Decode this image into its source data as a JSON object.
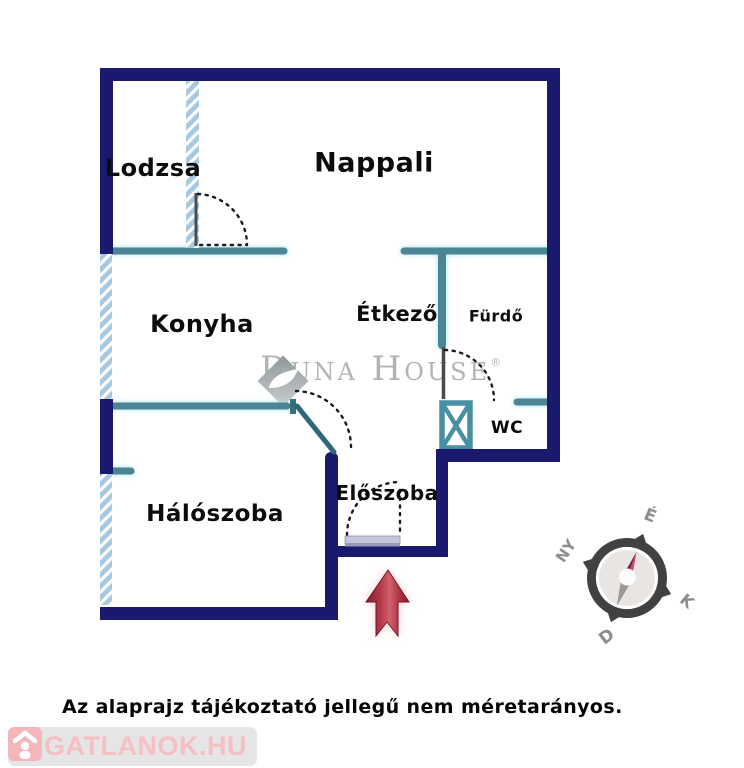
{
  "floor_plan": {
    "rooms": [
      {
        "name": "Lodzsa"
      },
      {
        "name": "Nappali"
      },
      {
        "name": "Konyha"
      },
      {
        "name": "Étkező"
      },
      {
        "name": "Fürdő"
      },
      {
        "name": "WC"
      },
      {
        "name": "Hálószoba"
      },
      {
        "name": "Előszoba"
      }
    ],
    "compass": {
      "north": "É",
      "west": "NY",
      "east": "K",
      "south": "D"
    },
    "watermark": {
      "brand": "Duna House",
      "registered_mark": "®"
    },
    "disclaimer": "Az alaprajz tájékoztató jellegű nem méretarányos.",
    "site_logo_text": "INGATLANOK.HU",
    "colors": {
      "load_bearing_wall": "#191a6e",
      "partition_wall": "#4c8593",
      "partition_glow": "#bde8f5",
      "window_hatch": "#a6c8e1",
      "entrance_arrow": "#b03245",
      "entrance_door": "#c6c6da",
      "watermark_gray": "#b3b3b3",
      "logo_pink": "#f4b8bc",
      "compass_ring": "#414141"
    }
  }
}
